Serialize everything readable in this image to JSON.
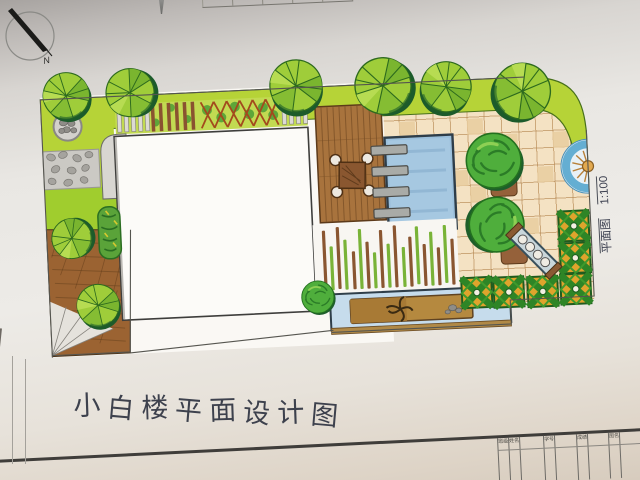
{
  "compass": {
    "north_label": "N"
  },
  "scale_note": {
    "drawing_label": "平面图",
    "scale": "1:100"
  },
  "title": {
    "text": "小白楼平面设计图",
    "chars": [
      "小",
      "白",
      "楼",
      "平",
      "面",
      "设",
      "计",
      "图"
    ]
  },
  "title_block": {
    "cells": [
      "班级",
      "姓名",
      "学号",
      "成绩",
      "图名"
    ]
  },
  "palette": {
    "lawn_green": "#b6d337",
    "tree_green": "#9ecd3a",
    "tree_shadow": "#1c5b2b",
    "shrub_green": "#4fae3c",
    "wood_deck": "#9b6332",
    "tile_paving": "#f4e2c3",
    "pool_blue": "#9cc0dc",
    "water_channel": "#c6dcec",
    "planting_module_yellow": "#dfa42c",
    "stone_gray": "#c9c7c2"
  }
}
